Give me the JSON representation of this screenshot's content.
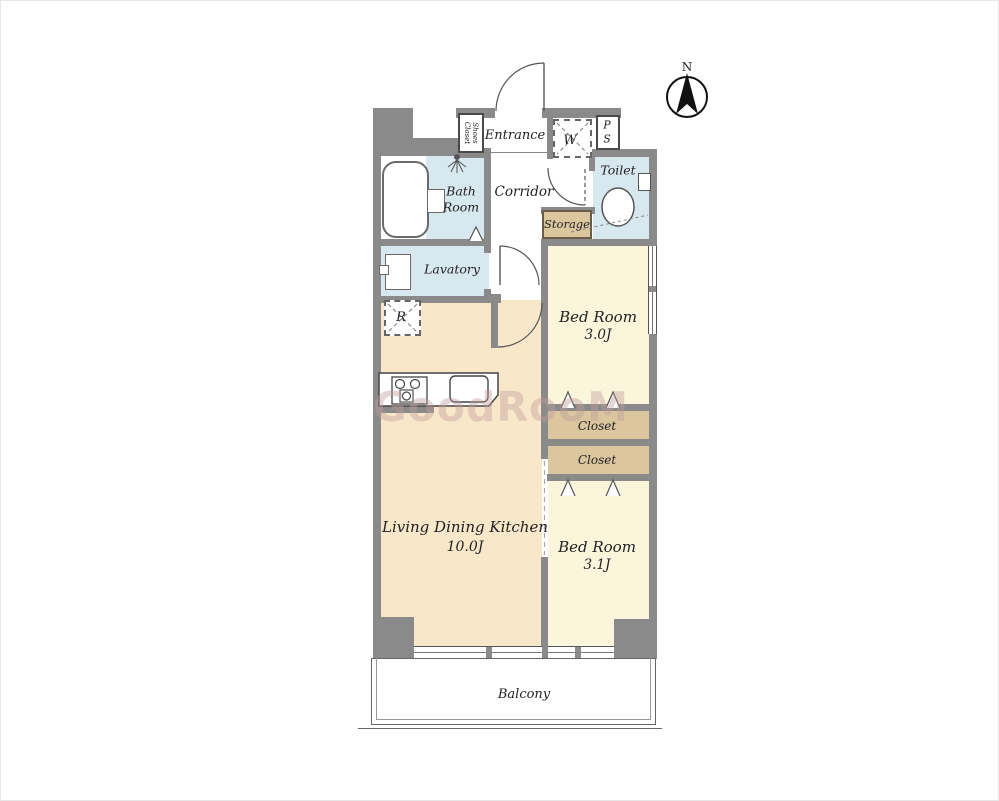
{
  "image_type": "apartment floor plan",
  "compass": {
    "north_label": "N"
  },
  "watermark": {
    "text": "GoodRooM"
  },
  "rooms": {
    "entrance": {
      "label": "Entrance"
    },
    "shoes_closet": {
      "line1": "Shoes",
      "line2": "Closet"
    },
    "washing_machine": {
      "label": "W"
    },
    "pipe_space": {
      "line1": "P",
      "line2": "S"
    },
    "toilet": {
      "label": "Toilet"
    },
    "bath": {
      "line1": "Bath",
      "line2": "Room"
    },
    "corridor": {
      "label": "Corridor"
    },
    "storage": {
      "label": "Storage"
    },
    "lavatory": {
      "label": "Lavatory"
    },
    "refrigerator": {
      "label": "R"
    },
    "bedroom1": {
      "label": "Bed Room",
      "size": "3.0J"
    },
    "closet1": {
      "label": "Closet"
    },
    "closet2": {
      "label": "Closet"
    },
    "ldk": {
      "label": "Living Dining Kitchen",
      "size": "10.0J"
    },
    "bedroom2": {
      "label": "Bed Room",
      "size": "3.1J"
    },
    "balcony": {
      "label": "Balcony"
    }
  },
  "colors": {
    "wall": "#8a8a8a",
    "wet_room_fill": "#d7e9ef",
    "ldk_fill": "#f9e7ca",
    "bedroom_fill": "#fbf5dc",
    "closet_fill": "#dbc69e",
    "storage_border": "#6a5c49",
    "watermark": "#c19e9e"
  }
}
